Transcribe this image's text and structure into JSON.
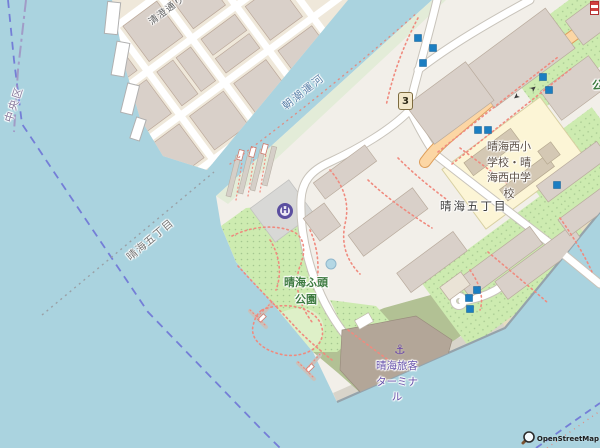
{
  "labels": {
    "kiyosumi_road": "清澄通り",
    "asashio_canal": "朝潮運河",
    "chuo_ward": "中央区",
    "harumi_5chome_water": "晴海五丁目",
    "harumi_5chome_land": "晴海五丁目",
    "harumi_nishi_school": "晴海西小\n学校・晴\n海西中学\n校",
    "harumi_wharf_park": "晴海ふ頭\n公園",
    "harumi_passenger_terminal": "晴海旅客\nターミナ\nル",
    "park_partial_right_edge": "公",
    "route_shield": "3",
    "helipad_letter": "H"
  },
  "icons": {
    "anchor": "⚓",
    "oneway_arrow_ne": "➤",
    "oneway_arrow_sw": "➤"
  },
  "attribution": {
    "text": "OpenStreetMap"
  },
  "colors": {
    "water": "#aad3df",
    "land": "#f2efe9",
    "land_district": "#efe8da",
    "building": "#d9d0c9",
    "park_green": "#cdebb0",
    "lawn_green": "#def0c8",
    "scrub_olive": "#b2c194",
    "school_yellow": "#fcf5d6",
    "road_orange": "#fcd6a4",
    "road_white": "#ffffff",
    "path_red": "#f08a7e",
    "boundary_blue": "#6b6fd6",
    "poi_marker_blue": "#1b7ec2",
    "helipad_purple": "#5b4fa0",
    "terminal_label_purple": "#6752ab",
    "water_label_blue": "#577fa8",
    "park_label_green": "#3e7b41",
    "beach_sand": "#e7ddc2",
    "terminal_building": "#b3a698"
  }
}
